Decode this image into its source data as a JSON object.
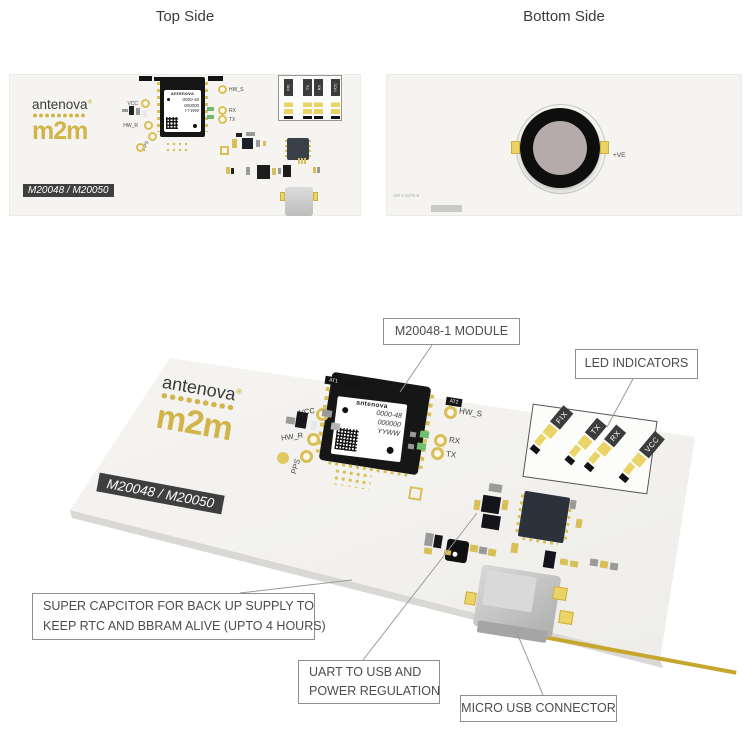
{
  "titles": {
    "top": "Top Side",
    "bottom": "Bottom Side"
  },
  "board": {
    "brand": "antenova",
    "brand_reg": "®",
    "brand_m2m": "m2m",
    "model": "M20048 / M20050",
    "module": {
      "name": "antenova",
      "line1": "0000-48",
      "line2": "000000",
      "line3": "YYWW"
    },
    "points": {
      "vcc": "VCC",
      "hw_r": "HW_R",
      "pps": "PPS",
      "hw_s": "HW_S",
      "rx": "RX",
      "tx": "TX"
    },
    "at1": "AT1",
    "at2": "AT2",
    "leds": {
      "fix": "FIX",
      "tx": "TX",
      "rx": "RX",
      "vcc": "VCC"
    }
  },
  "bottom": {
    "plus_ve": "+VE",
    "ref": "AM 1-3475-6"
  },
  "callouts": {
    "module": "M20048-1 MODULE",
    "led": "LED INDICATORS",
    "supercap1": "SUPER CAPCITOR FOR BACK UP SUPPLY TO",
    "supercap2": "KEEP RTC AND BBRAM ALIVE (UPTO 4 HOURS)",
    "uart1": "UART TO USB AND",
    "uart2": "POWER REGULATION",
    "usb": "MICRO USB CONNECTOR"
  },
  "colors": {
    "gold": "#d2b54a",
    "pad_gold": "#ead467",
    "board_white": "#f5f4f1",
    "label_dark": "#3f3f3f",
    "callout_border": "#8f8f8f",
    "leader_line": "#9a9a9a"
  }
}
